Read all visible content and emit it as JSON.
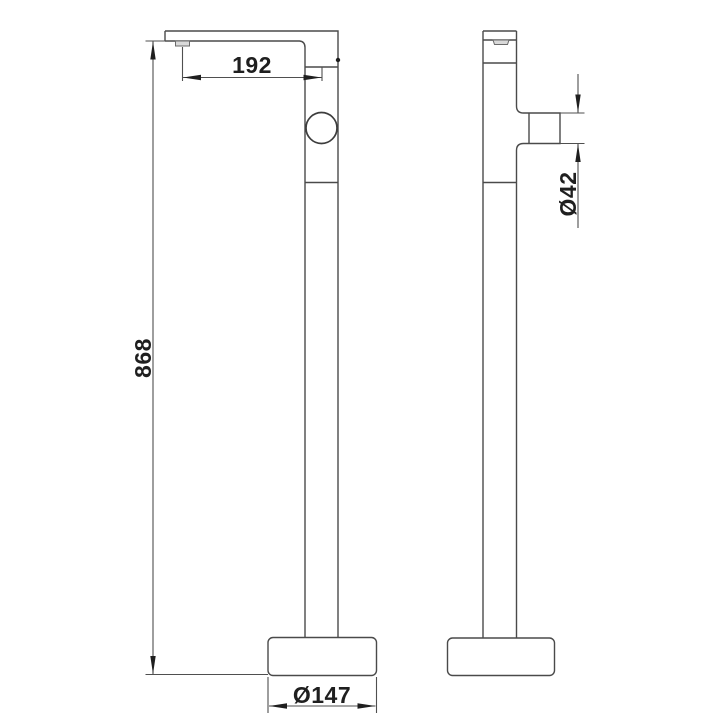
{
  "drawing": {
    "kind": "technical-dimension-drawing",
    "subject": "freestanding bathtub faucet, front and side orthographic views",
    "background_color": "#ffffff",
    "line_color": "#4a4a4a",
    "text_color": "#1f1f1f",
    "detail_fill_color": "#d9d9d9",
    "dimensions": {
      "spout_reach": "192",
      "total_height": "868",
      "base_diameter": "Ø147",
      "knob_diameter": "Ø42"
    }
  }
}
